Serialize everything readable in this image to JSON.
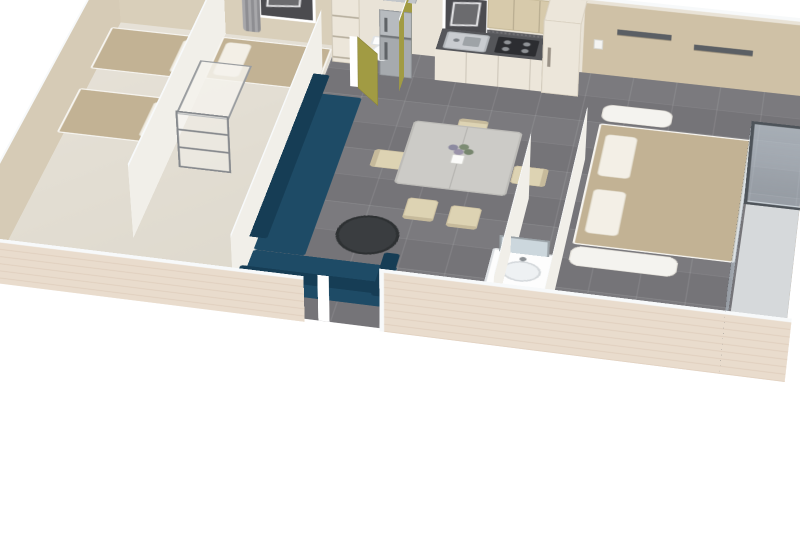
{
  "scene": {
    "title": "3D isometric cutaway floor plan render of a mobile home",
    "style": "photoreal 3D render, angled top-down view, cut walls with white caps",
    "background": "#ffffff"
  },
  "rooms": [
    {
      "id": "bedroom-1",
      "label": "twin bedroom",
      "furniture": [
        "single-bed",
        "single-bed",
        "wall-shelves"
      ]
    },
    {
      "id": "bedroom-2",
      "label": "second bedroom",
      "furniture": [
        "single-bed",
        "transparent-wardrobe",
        "curtained-window",
        "wall-shelf"
      ]
    },
    {
      "id": "wc",
      "label": "separate toilet",
      "furniture": [
        "toilet",
        "olive-open-door",
        "shelf-unit"
      ]
    },
    {
      "id": "kitchen",
      "label": "kitchenette",
      "furniture": [
        "fridge-freezer",
        "sink",
        "gas-hob",
        "upper-cabinets",
        "splashback",
        "tall-cabinet",
        "window"
      ]
    },
    {
      "id": "living-room",
      "label": "living / dining area",
      "furniture": [
        "blue-corner-sofa",
        "round-coffee-table",
        "dining-table",
        "flower-vase",
        "dining-chairs"
      ]
    },
    {
      "id": "bathroom",
      "label": "shower room",
      "furniture": [
        "washbasin-vanity",
        "mirror"
      ]
    },
    {
      "id": "master-bedroom",
      "label": "master bedroom",
      "furniture": [
        "double-bed",
        "bedside-ledges",
        "wall-shelves",
        "glass-wardrobe"
      ]
    }
  ],
  "counts": {
    "dining_chairs": 5,
    "beds": 4,
    "back_wall_windows": 2,
    "open_doors": 1,
    "wall_shelves": 6
  },
  "colors": {
    "bg": "#ffffff",
    "trim": "#f7f9fa",
    "wall_bedrooms": "#d9cfba",
    "wall_living": "#e9e3d7",
    "wall_master": "#cfc1a6",
    "wall_end": "#d6cbb6",
    "wall_end_right": "#cdbfa4",
    "partition": "#f1efe9",
    "wood_outer_a": "#e9dccd",
    "wood_outer_b": "#e0cfbe",
    "floor_bedroom": "#e7e2d8",
    "floor_tile": "#7b7a7e",
    "tile_line": "rgba(255,255,255,0.10)",
    "sofa": "#1e4b66",
    "sofa_dark": "#163d55",
    "coffee_table": "#3a3d40",
    "blanket": "#c2b294",
    "pillow": "#f3efe6",
    "table_top": "#cccbc7",
    "chair": "#ddd3b3",
    "counter_top": "#55565a",
    "cabinet_base": "#ece6da",
    "cabinet_wood": "#d7caab",
    "splashback": "#5d5d61",
    "fridge_a": "#b7bbbf",
    "fridge_b": "#a6aaae",
    "olive": "#a19b43",
    "glass_fill": "rgba(186,200,212,0.45)",
    "glass_frame": "#4e545a",
    "window_glass": "#4b4b4f",
    "curtain_a": "#a7a7aa",
    "curtain_b": "#8e8e92",
    "rod": "#3d3d40",
    "shelf_dark": "#5b5f64",
    "mirror": "#ccd7dd",
    "white": "#ffffff"
  }
}
